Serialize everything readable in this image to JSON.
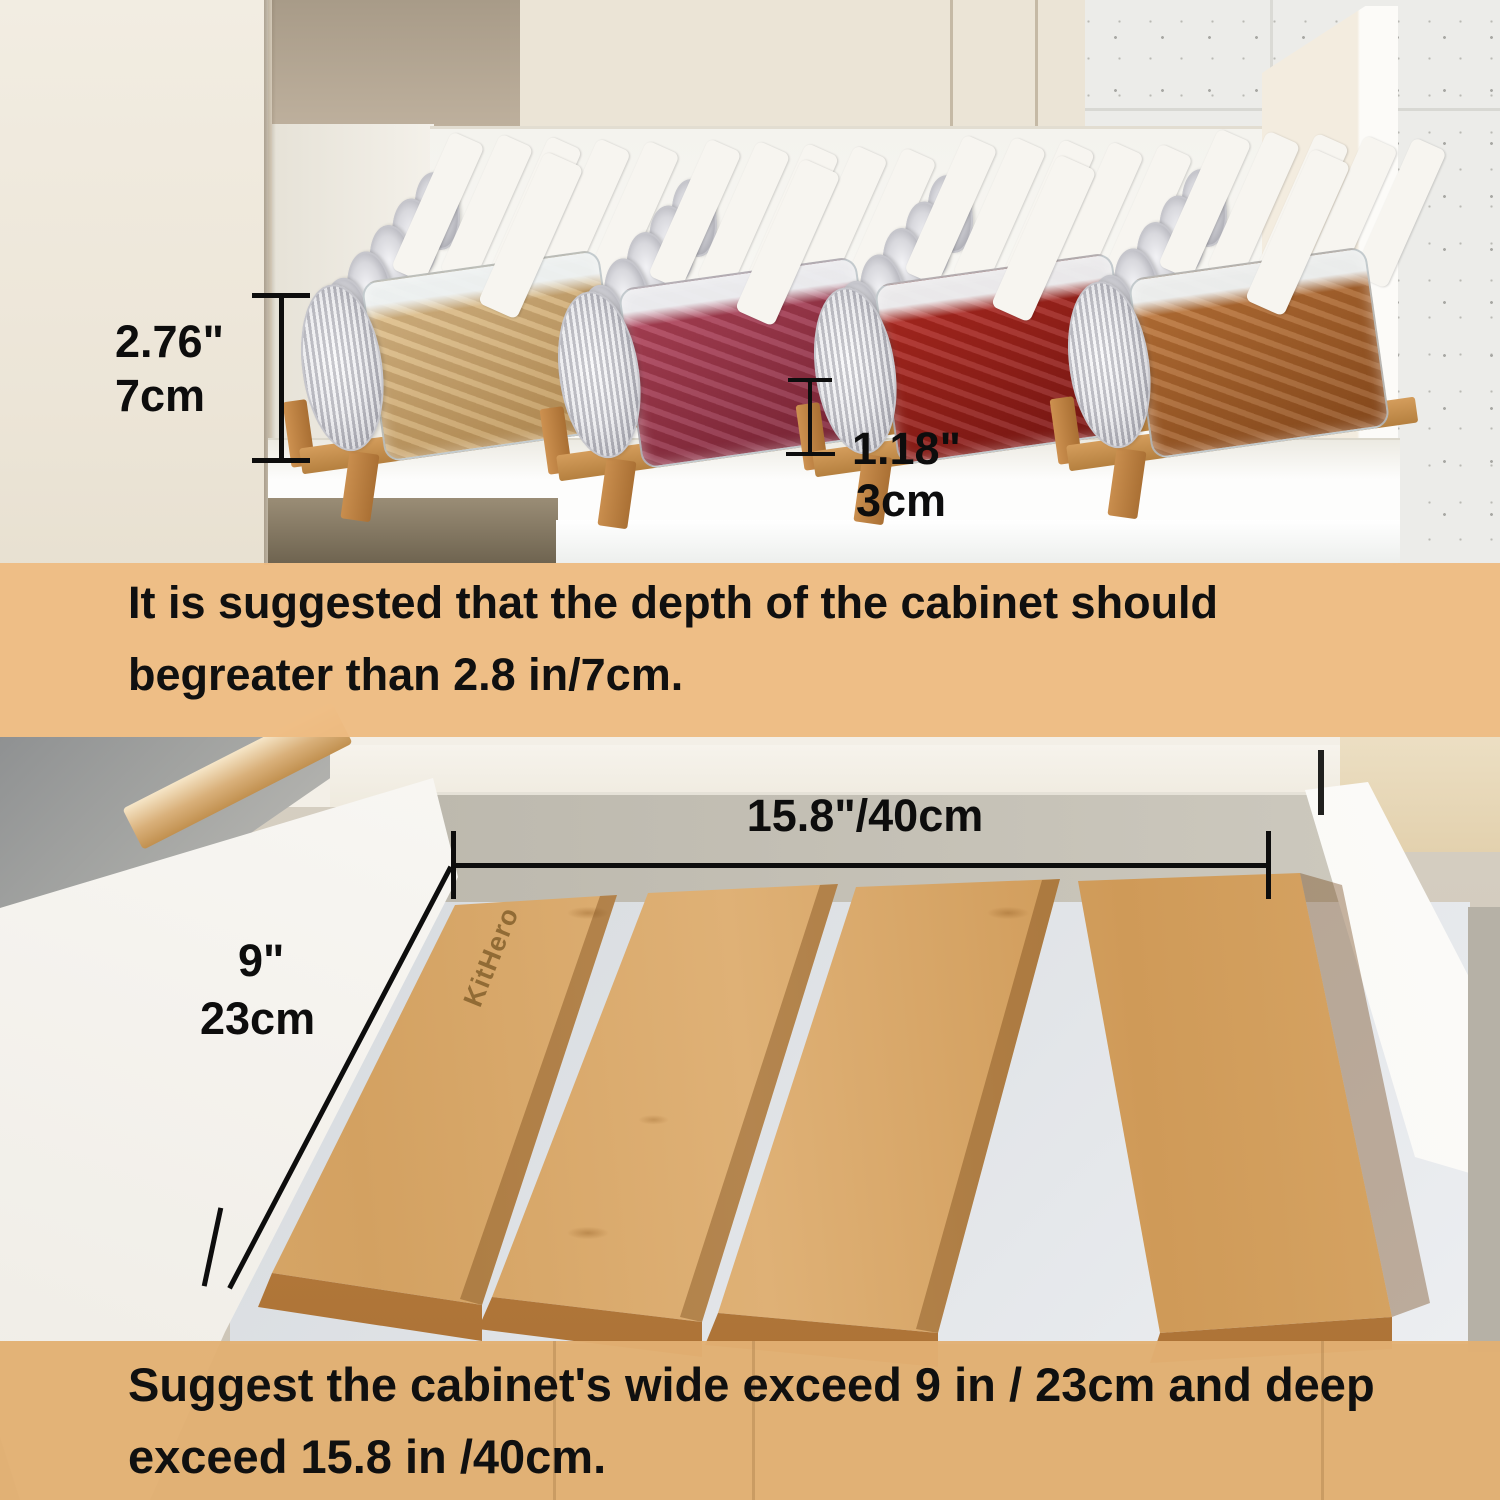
{
  "image_type": "product-dimension-infographic",
  "colors": {
    "band_top": "rgba(238,188,130,0.95)",
    "band_bottom": "rgba(226,176,114,0.96)",
    "annotation_ink": "#0d0d0d",
    "bamboo_light": "#dcae72",
    "bamboo_dark": "#b5803f",
    "silver_lid": "#c9c9d0",
    "tile_wall": "#ecece9",
    "cream_cabinet": "#ebe4d6",
    "greige_wall": "#cdc5b8",
    "white_panel": "#f8f7f4"
  },
  "top_photo": {
    "scene": "open kitchen drawer with four bamboo spice-rack stands holding labeled glass spice jars",
    "height_dim": {
      "inches": "2.76\"",
      "metric": "7cm"
    },
    "lip_dim": {
      "inches": "1.18\"",
      "metric": "3cm"
    },
    "racks": [
      {
        "name": "ginger-jars",
        "content_color_a": "#e3c592",
        "content_color_b": "#bb9255"
      },
      {
        "name": "rose-bud-jars",
        "content_color_a": "#b6465e",
        "content_color_b": "#7c2338"
      },
      {
        "name": "chili-jars",
        "content_color_a": "#b62a22",
        "content_color_b": "#7a1513"
      },
      {
        "name": "dried-seafood-jars",
        "content_color_a": "#c27a3c",
        "content_color_b": "#8d4d1e"
      }
    ]
  },
  "top_note": {
    "line1": "It is suggested that the depth of the cabinet should",
    "line2": "begreater than 2.8 in/7cm."
  },
  "bottom_photo": {
    "scene": "empty drawer with four slanted bamboo rack panels",
    "brand": "KitHero",
    "width_dim": "15.8\"/40cm",
    "depth_dim": {
      "inches": "9\"",
      "metric": "23cm"
    },
    "panel_count": 4
  },
  "bottom_note": {
    "line1": "Suggest the cabinet's wide exceed 9 in / 23cm and deep",
    "line2": "exceed 15.8 in /40cm."
  }
}
